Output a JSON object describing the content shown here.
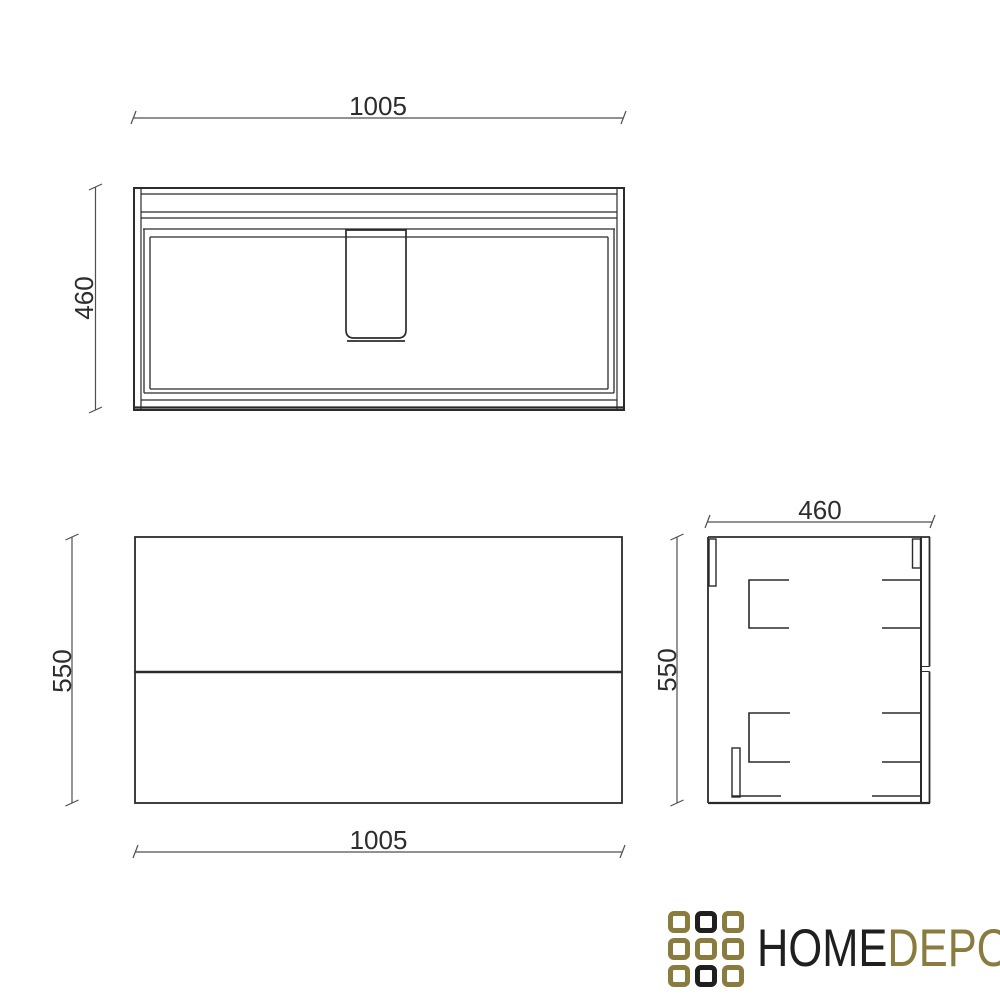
{
  "drawing": {
    "line_color": "#2b2b2b",
    "dim_line_color": "#4f4f4f",
    "views": {
      "top": {
        "width_label": "1005",
        "depth_label": "460"
      },
      "front": {
        "height_label": "550",
        "width_label": "1005"
      },
      "side": {
        "width_label": "460",
        "height_label": "550"
      }
    }
  },
  "logo": {
    "word_primary": "HOME",
    "word_secondary": "DEPO",
    "color_primary": "#1f1f1f",
    "color_secondary": "#8a7b3e",
    "grid_cells": [
      "gold",
      "black",
      "gold",
      "gold",
      "gold",
      "gold",
      "gold",
      "black",
      "gold"
    ]
  }
}
